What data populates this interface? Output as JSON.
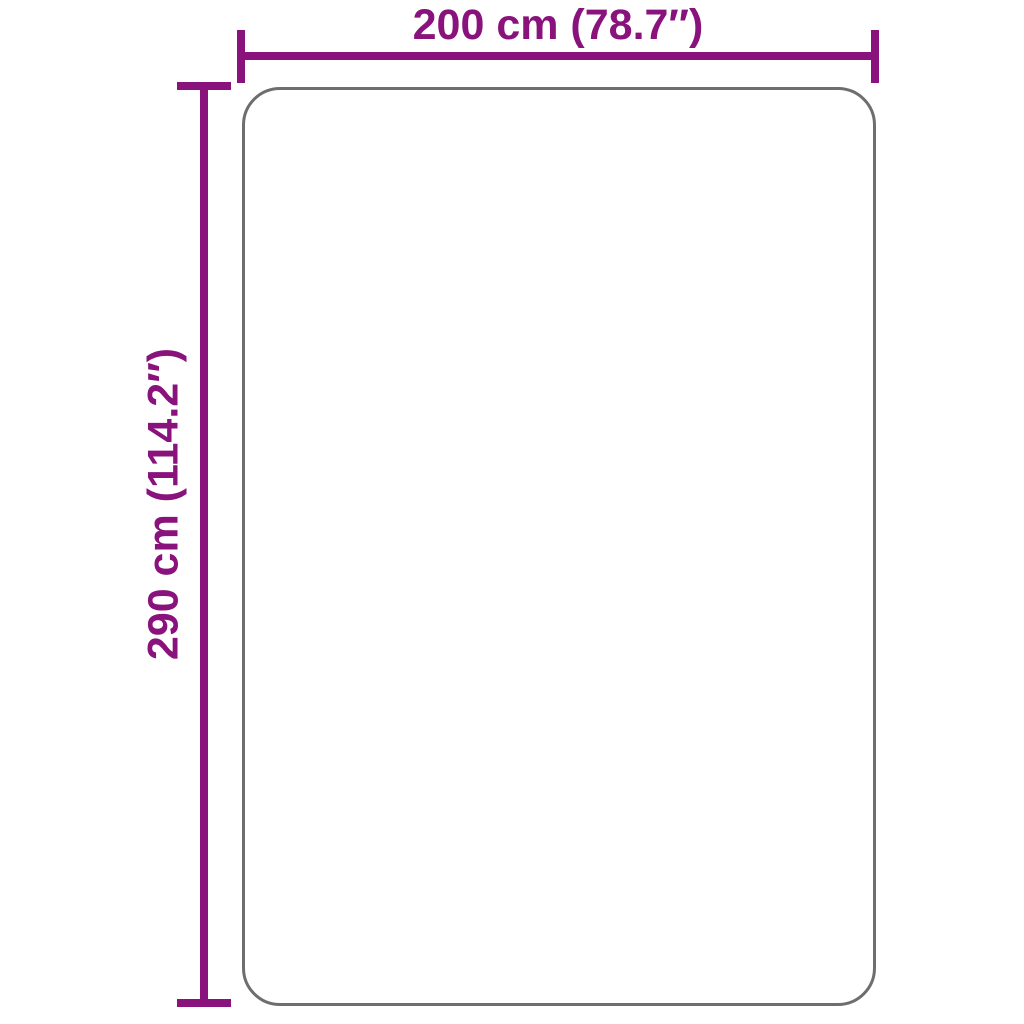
{
  "diagram": {
    "kind": "product-dimension-diagram",
    "width_label": "200 cm (78.7″)",
    "height_label": "290 cm (114.2″)",
    "width_cm": 200,
    "height_cm": 290,
    "width_inches": 78.7,
    "height_inches": 114.2
  },
  "colors": {
    "dimension": "#8A127C",
    "outline": "#6E6E6E",
    "background": "#FFFFFF"
  }
}
